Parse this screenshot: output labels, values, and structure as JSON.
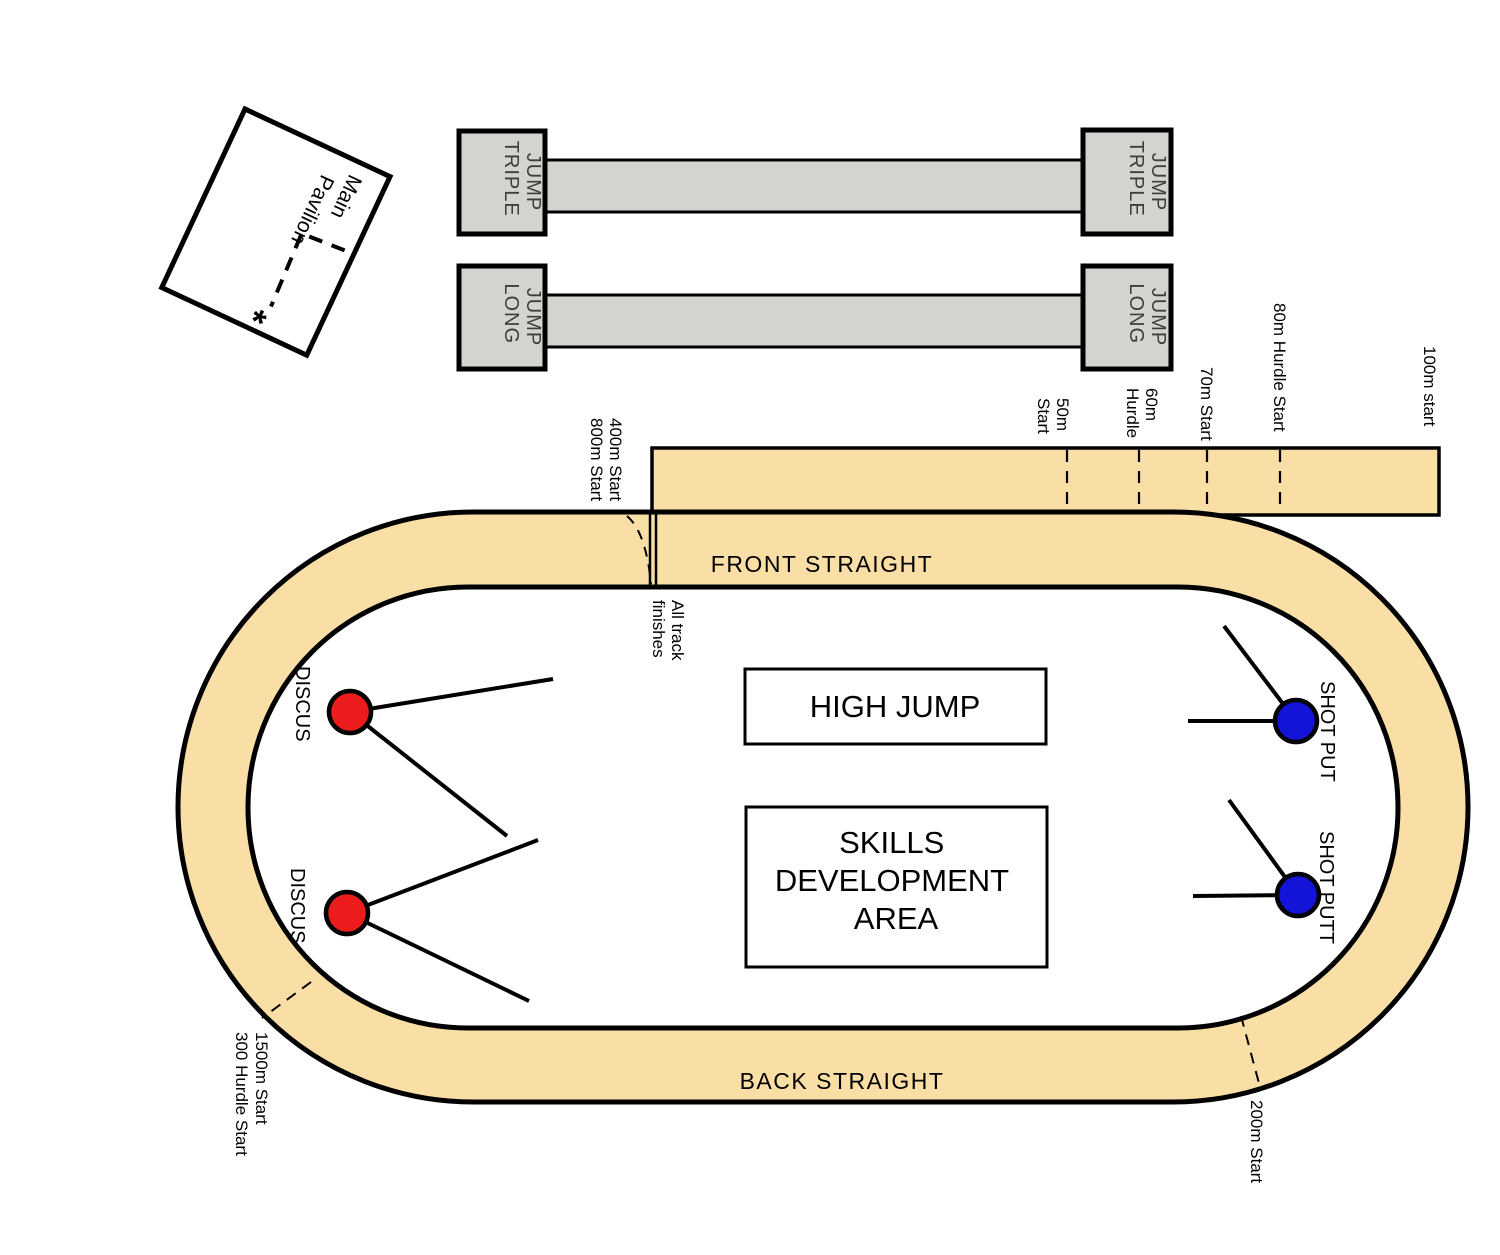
{
  "title": "Athletics track and field layout diagram",
  "colors": {
    "track_surface": "#f9dfa5",
    "runway_gray": "#d3d3d0",
    "discus_circle": "#ed1c1c",
    "shot_put_circle": "#1414d8",
    "outline": "#000000"
  },
  "pavilion": {
    "line1": "Main",
    "line2": "Pavilion",
    "marker": "*"
  },
  "runways": {
    "triple": {
      "line1": "TRIPLE",
      "line2": "JUMP"
    },
    "long": {
      "line1": "LONG",
      "line2": "JUMP"
    }
  },
  "track": {
    "front_straight": "FRONT STRAIGHT",
    "back_straight": "BACK STRAIGHT",
    "marks": {
      "m400_800": {
        "line1": "400m Start",
        "line2": "800m Start"
      },
      "m50": {
        "line1": "50m",
        "line2": "Start"
      },
      "m60": {
        "line1": "60m",
        "line2": "Hurdle"
      },
      "m70": "70m Start",
      "m80": "80m Hurdle Start",
      "m100": "100m start",
      "m200": "200m Start",
      "m1500": {
        "line1": "1500m Start",
        "line2": "300 Hurdle Start"
      },
      "finish": {
        "line1": "All track",
        "line2": "finishes"
      }
    }
  },
  "infield": {
    "high_jump": "HIGH JUMP",
    "skills": {
      "line1": "SKILLS",
      "line2": "DEVELOPMENT",
      "line3": "AREA"
    },
    "throws": {
      "discus_top": "DISCUS",
      "discus_bottom": "DISCUS",
      "shot_top": "SHOT PUT",
      "shot_bottom": "SHOT PUTT"
    }
  }
}
